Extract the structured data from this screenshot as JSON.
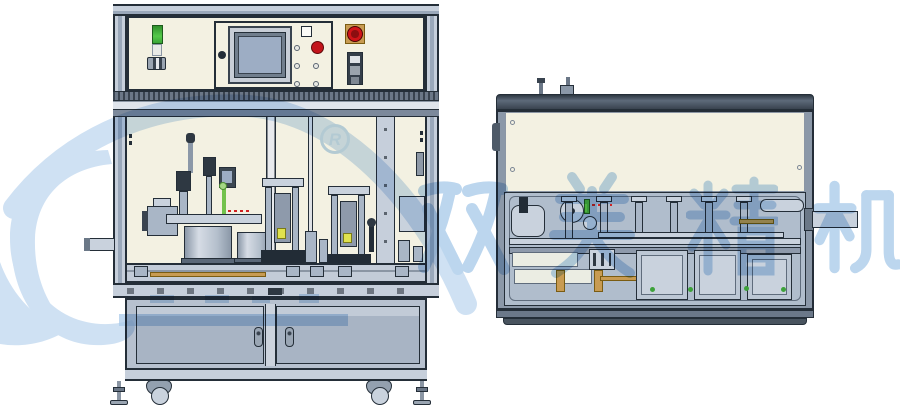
{
  "page": {
    "width": 900,
    "height": 410,
    "background": "#ffffff"
  },
  "colors": {
    "ink": "#242e38",
    "panel_cream": "#f3f1e2",
    "frame_light": "#c6cfdb",
    "frame_mid": "#9aa8ba",
    "frame_dark": "#5d6a7a",
    "machine_gray": "#a9b6c6",
    "machine_light": "#c9d2dd",
    "door_gray": "#a8b4c4",
    "screen_blue": "#9dadc4",
    "status_green": "#43b13a",
    "alarm_red": "#c3151b",
    "gold": "#c89b52",
    "watermark_blue": "#bcd6ee",
    "swoosh_blue": "#cfe1f3"
  },
  "watermark": {
    "registered_symbol": "R",
    "brand_characters": [
      "双",
      "美",
      "精",
      "机"
    ]
  },
  "machines": {
    "front_view_components": [
      "aluminum-frame",
      "control-panel",
      "signal-tower-light",
      "hmi-touchscreen",
      "membrane-buttons",
      "emergency-stop-button",
      "mode-selector-switch",
      "safety-enclosure",
      "rotary-index-table",
      "pick-place-cylinders",
      "press-station",
      "conveyor-line",
      "infeed-conveyor-stub",
      "equipment-cabinet",
      "cabinet-doors",
      "door-handles",
      "caster-wheels",
      "leveling-feet"
    ],
    "side_view_components": [
      "top-cover-panel",
      "panel-screws",
      "lifting-posts",
      "side-handle",
      "drive-pulleys",
      "linear-slide-columns",
      "guide-rails",
      "tooling-plates",
      "part-nests",
      "output-arm",
      "base-skirt"
    ]
  }
}
